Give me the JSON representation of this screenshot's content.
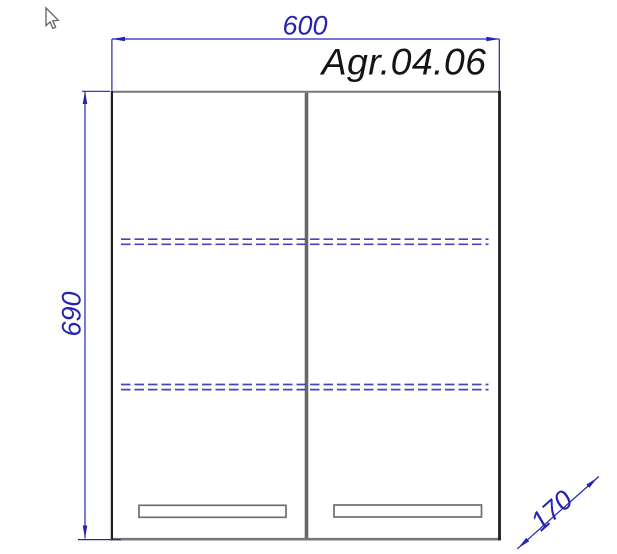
{
  "drawing": {
    "model_label": "Agr.04.06",
    "width_mm": "600",
    "height_mm": "690",
    "depth_mm": "170",
    "colors": {
      "dimension_blue": "#2424ae",
      "shelf_blue": "#4646b8",
      "edge_dark": "#1e1e1e",
      "edge_gray": "#787878",
      "divider_gray": "#686868",
      "handle_gray": "#6f6f6f",
      "label_dark": "#141414",
      "cursor_gray": "#6a6a6a",
      "background": "#ffffff"
    },
    "icons": {
      "cursor": "mouse-arrow-cursor"
    }
  }
}
